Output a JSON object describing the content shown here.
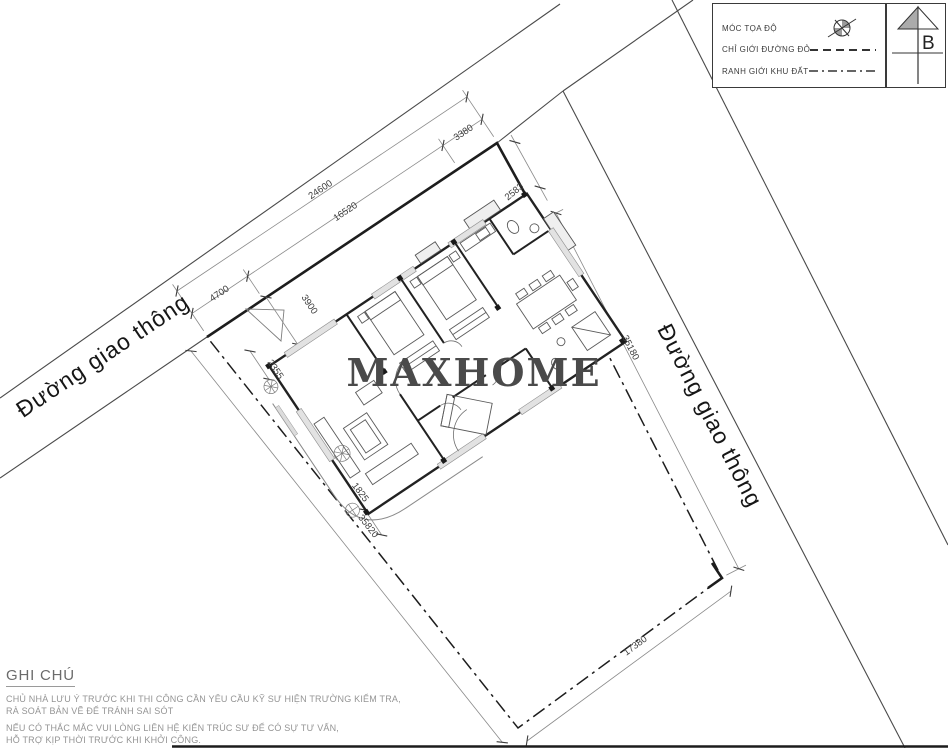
{
  "title": "Site plan drawing",
  "watermark": "MAXHOME",
  "roads": {
    "left_label": "Đường giao thông",
    "right_label": "Đường giao thông"
  },
  "north": {
    "label": "B"
  },
  "legend": {
    "items": [
      {
        "label": "MÓC TỌA ĐỘ",
        "symbol": "survey-marker"
      },
      {
        "label": "CHỈ GIỚI ĐƯỜNG ĐỎ",
        "symbol": "dashed-line"
      },
      {
        "label": "RANH GIỚI KHU ĐẤT",
        "symbol": "dash-dot-line"
      }
    ]
  },
  "dimensions": {
    "frontage_total": "24600",
    "frontage_left": "4700",
    "frontage_mid": "16520",
    "frontage_right": "3380",
    "top_right_edge": "2583",
    "setback_front": "3900",
    "setback_left": "2355",
    "setback_bottom": "1825",
    "boundary_left": "35820",
    "boundary_right": "35180",
    "boundary_bottom": "17380"
  },
  "notes": {
    "title": "GHI CHÚ",
    "lines": [
      "CHỦ NHÀ LƯU Ý TRƯỚC KHI THI CÔNG CẦN YÊU CẦU KỸ SƯ HIỆN TRƯỜNG KIỂM TRA,",
      "RÀ SOÁT BẢN VẼ ĐỂ TRÁNH SAI SÓT",
      "NẾU CÓ THẮC MẮC VUI LÒNG LIÊN HỆ KIẾN TRÚC SƯ ĐỂ CÓ SỰ TƯ VẤN,",
      "HỖ TRỢ KỊP THỜI TRƯỚC KHI KHỞI CÔNG."
    ]
  },
  "colors": {
    "boundary": "#2b2b2b",
    "road_line": "#4a4a4a",
    "dim_line": "#8a8a8a",
    "dim_text": "#3c3c3c",
    "notes_text": "#949494",
    "watermark": "#4a4a4a"
  }
}
